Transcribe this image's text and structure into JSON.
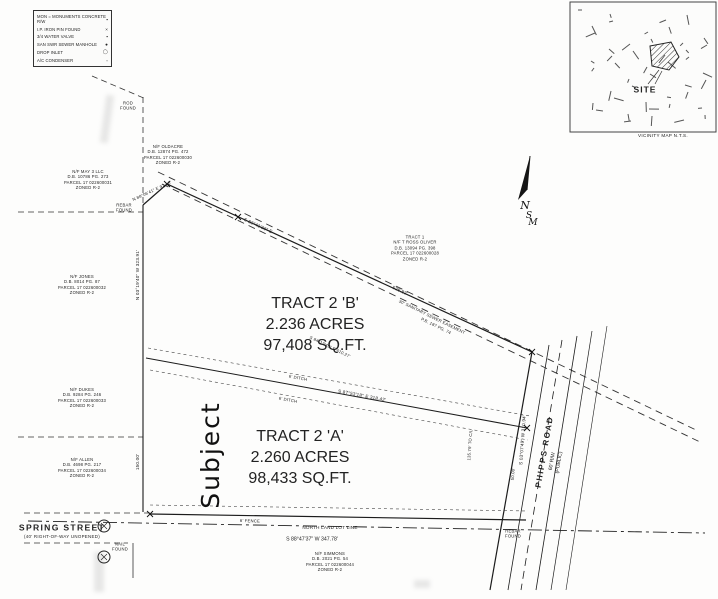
{
  "legend": {
    "rows": [
      {
        "label": "MON = MONUMENTS CONCRETE R/W",
        "sym": "▪"
      },
      {
        "label": "I.P. IRON PIN FOUND",
        "sym": "×"
      },
      {
        "label": "3/4 WATER VALVE",
        "sym": "▪"
      },
      {
        "label": "SAN SWR SEWER MANHOLE",
        "sym": "●"
      },
      {
        "label": "DROP INLET",
        "sym": "◯"
      },
      {
        "label": "A/C CONDENSER",
        "sym": "▫"
      }
    ]
  },
  "vicinity": {
    "site_label": "SITE",
    "caption": "VICINITY MAP   N.T.S."
  },
  "north_arrow": {
    "n": "N",
    "s": "S",
    "m": "M"
  },
  "tracts": {
    "b": {
      "lines": [
        "TRACT 2 'B'",
        "2.236 ACRES",
        "97,408 SQ.FT."
      ]
    },
    "a": {
      "lines": [
        "TRACT 2 'A'",
        "2.260 ACRES",
        "98,433 SQ.FT."
      ]
    }
  },
  "subject_note": "Subject",
  "roads": {
    "spring": {
      "name": "SPRING STREET",
      "sub": "(40' RIGHT-OF-WAY  UNOPENED)"
    },
    "phipps": {
      "name": "PHIPPS ROAD",
      "sub": [
        "60' R/W",
        "(PUBLIC)"
      ]
    }
  },
  "parcels": {
    "nw": {
      "lines": [
        "N/F MAY 3 LLC",
        "D.B. 10786 PG. 273",
        "PARCEL 17 022600031",
        "ZONED R-2"
      ]
    },
    "west1": {
      "lines": [
        "N/F JONES",
        "D.B. 8014 PG. 87",
        "PARCEL 17 022600032",
        "ZONED R-2"
      ]
    },
    "west2": {
      "lines": [
        "N/F DUKES",
        "D.B. 9284 PG. 246",
        "PARCEL 17 022600033",
        "ZONED R-2"
      ]
    },
    "west3": {
      "lines": [
        "N/F ALLEN",
        "D.B. 4698 PG. 217",
        "PARCEL 17 022600034",
        "ZONED R-2"
      ]
    },
    "top": {
      "lines": [
        "N/F OLDACRE",
        "D.B. 12874 PG. 472",
        "PARCEL 17 022600030",
        "ZONED R-2"
      ]
    },
    "tract1": {
      "lines": [
        "TRACT 1",
        "N/F T ROSS OLIVER",
        "D.B. 13094 PG. 398",
        "PARCEL 17 022600028",
        "ZONED R-2"
      ]
    },
    "south": {
      "lines": [
        "N/F SIMMONS",
        "D.B. 2021 PG. 54",
        "PARCEL 17 022600044",
        "ZONED R-2"
      ]
    }
  },
  "bearings": {
    "nw_line": "N 88°06'41\" E  97.18'",
    "north_bearing": "S 82°41'33\" E",
    "north_dim": "528.83'",
    "easement_label": "30' SANITARY SEWER EASEMENT",
    "easement_ref": "P.B. 187  PG. 74",
    "easement_bearing": "S 84°12'45\" E   610.27'",
    "divider_bearing": "S 87°53'18\" E   318.42'",
    "ditch1": "6' DITCH",
    "ditch2": "6' DITCH",
    "west_bearing": "N 03°19'40\" W   323.91'",
    "west_dim": "150.00'",
    "east_bearing": "S 03°07'49\" W   310.94'",
    "dim_50": "50.00'",
    "dim_135": "135.79' TO C/L",
    "south_bearing": "S 88°47'37\" W   347.78'",
    "land_lot": "NORTH LAND LOT LINE",
    "fence": "6' FENCE"
  },
  "monuments": {
    "rod_top": [
      "ROD",
      "FOUND"
    ],
    "rebar_nw": [
      "REBAR",
      "FOUND"
    ],
    "nail_sw": [
      "NAIL",
      "FOUND"
    ],
    "rebar_se": [
      "REBAR",
      "FOUND"
    ]
  }
}
